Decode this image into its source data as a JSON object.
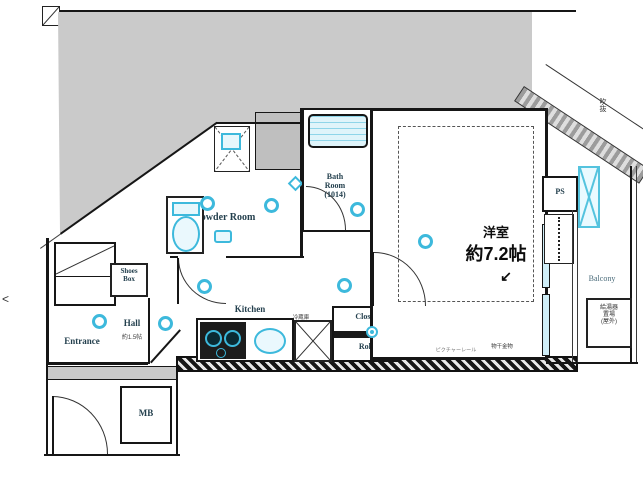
{
  "labels": {
    "main_room_name": "洋室",
    "main_room_size": "約7.2帖",
    "powder_room": "Powder Room",
    "bath_line1": "Bath",
    "bath_line2": "Room",
    "bath_line3": "(1014)",
    "kitchen": "Kitchen",
    "hall": "Hall",
    "hall_size": "約1.5帖",
    "entrance": "Entrance",
    "balcony": "Balcony",
    "shoes_line1": "Shoes",
    "shoes_line2": "Box",
    "closet_top": "Closet",
    "closet_bottom": "Roll",
    "fridge": "冷蔵庫",
    "meter_box": "MB",
    "pipe_space": "PS",
    "boiler_line1": "給湯器",
    "boiler_line2": "置場",
    "boiler_line3": "(屋外)",
    "picture_rail": "ピクチャーレール",
    "laundry_hook": "物干金物",
    "corner_note": "吹抜",
    "nav_arrow": "<",
    "direction_arrow": "↙"
  },
  "colors": {
    "accent": "#3db9dc",
    "wall": "#161616",
    "shade": "#cacaca"
  }
}
